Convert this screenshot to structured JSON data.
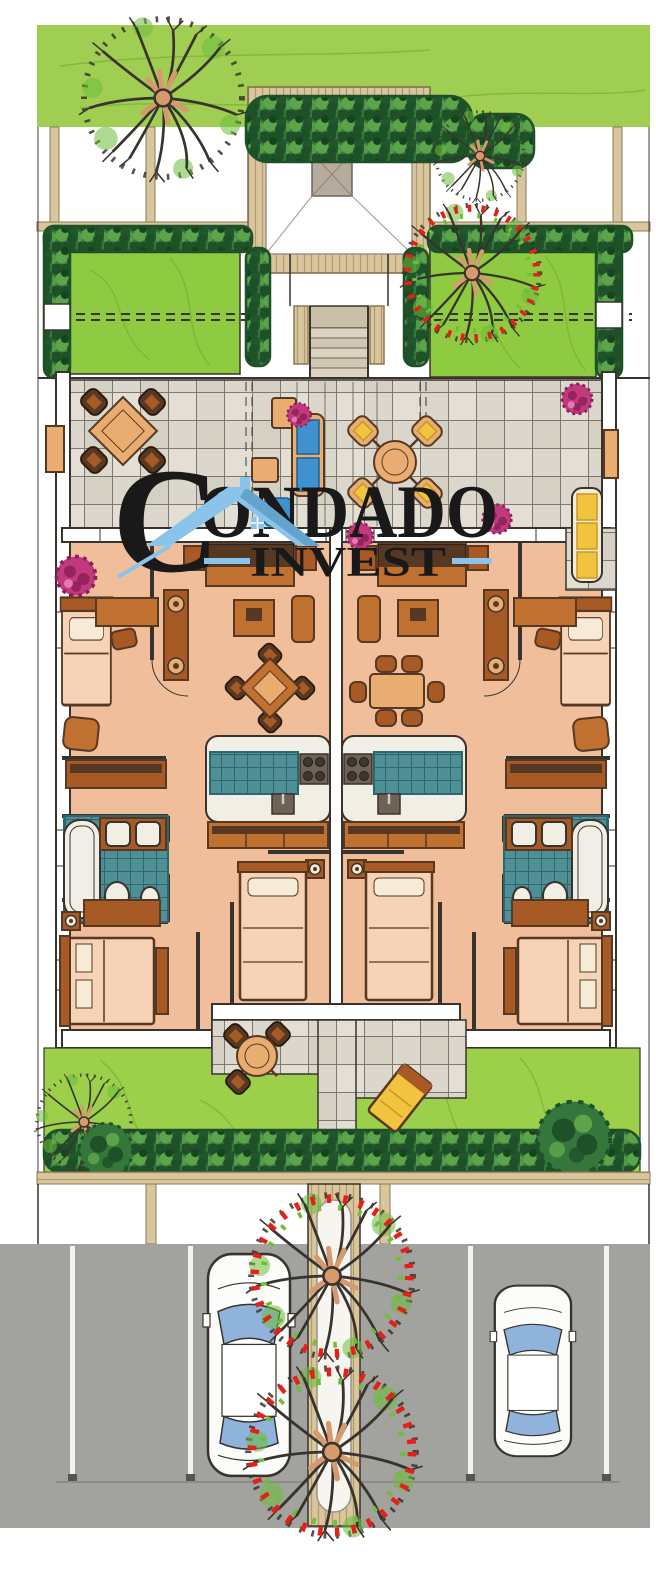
{
  "watermark": {
    "initial": "C",
    "rest": "ONDADO",
    "sub": "INVEST"
  },
  "palette": {
    "ink": "#38332C",
    "lawnStrip": "#A0CE53",
    "lawnGarden": "#8FCB40",
    "lawnBack": "#9CD04B",
    "grassLine": "#6FA832",
    "hedgeDark": "#1E5128",
    "hedgeMid": "#35763B",
    "hedgeLight": "#61A94C",
    "tan": "#D9C69D",
    "tanLine": "#B29C6E",
    "tanEdge": "#8A7A52",
    "tile": "#DBD7CC",
    "tileLight": "#E8E4DB",
    "tileDark": "#CEC9BD",
    "tileLine": "#5E594F",
    "floor": "#F0BE9B",
    "floorLight": "#F6D3B6",
    "wood": "#C0702F",
    "woodMid": "#A85A26",
    "woodDark": "#573822",
    "tableTan": "#E9AD72",
    "cream": "#F6EBD7",
    "teal": "#4F8F96",
    "tealLine": "#2E666E",
    "fixture": "#F1EEE6",
    "stove": "#6E6257",
    "magenta": "#C23A7E",
    "magentaDark": "#8C2058",
    "yellow": "#F2C33E",
    "yellowDeep": "#C89A1E",
    "blue": "#3E92D0",
    "asphalt": "#A2A29F",
    "glassBlue": "#8FB3DA",
    "carWhite": "#FCFCFB",
    "logoBlack": "#191919",
    "logoBlue": "#8AC4EA",
    "logoBlueDark": "#5D9EC7",
    "flowerRed": "#E32119",
    "leafGreen": "#6CBE3B",
    "trunk": "#D69A6E",
    "planterWhite": "#F7F5F0"
  },
  "icons": {
    "tree": "deciduous-tree",
    "flowering_tree": "flowering-tree",
    "shrub": "round-shrub",
    "pink_shrub": "flowering-shrub",
    "car": "car-top-view"
  }
}
